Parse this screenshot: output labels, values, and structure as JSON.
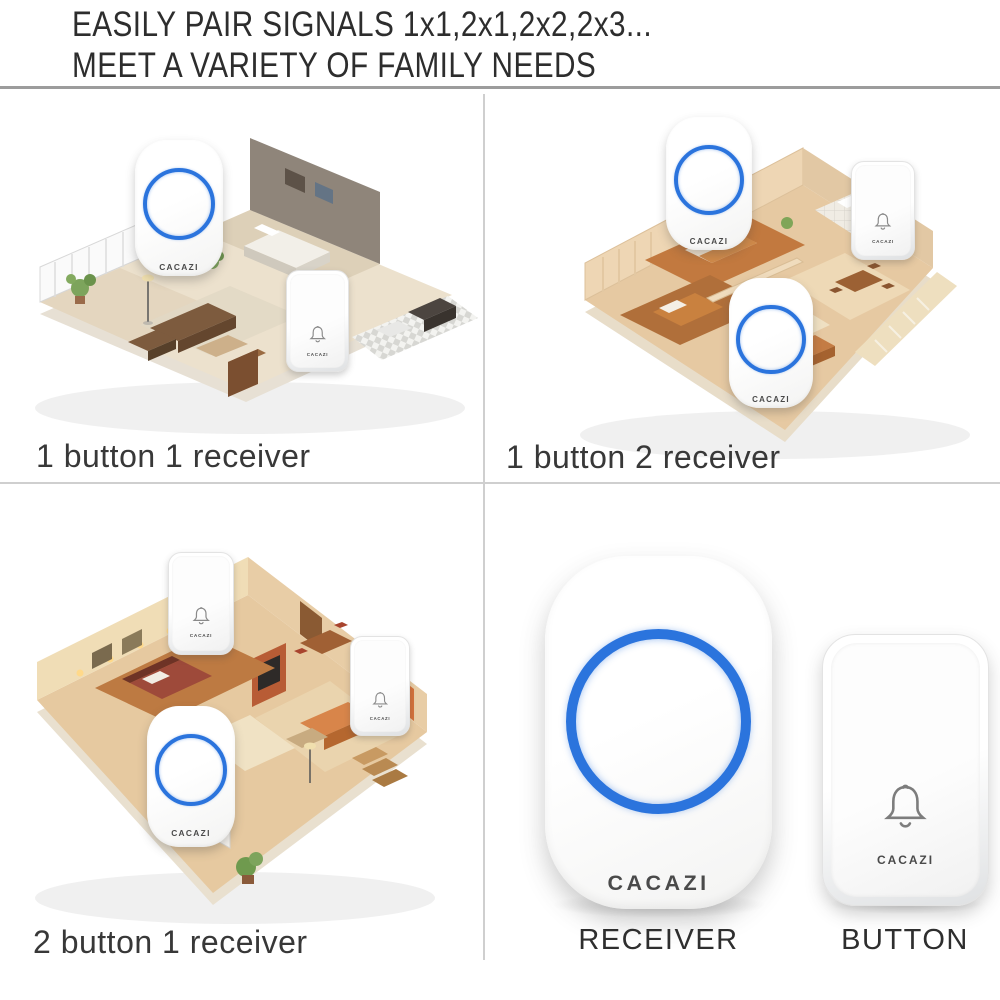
{
  "header": {
    "line1": "EASILY PAIR SIGNALS 1x1,2x1,2x2,2x3...",
    "line2": "MEET A VARIETY OF FAMILY NEEDS"
  },
  "brand": "CACAZI",
  "quadrants": [
    {
      "caption": "1 button 1 receiver",
      "buttons": 1,
      "receivers": 1
    },
    {
      "caption": "1 button 2 receiver",
      "buttons": 1,
      "receivers": 2
    },
    {
      "caption": "2 button 1 receiver",
      "buttons": 2,
      "receivers": 1
    }
  ],
  "products": {
    "receiver_label": "RECEIVER",
    "button_label": "BUTTON"
  },
  "icons": [
    {
      "name": "bell-icon",
      "shape": "outline bell glyph on push button"
    },
    {
      "name": "led-ring",
      "shape": "blue circular LED ring on receiver"
    }
  ],
  "colors": {
    "accent_blue": "#2b74dd",
    "divider": "#cfcfcf",
    "header_rule": "#9c9c9c",
    "text": "#383838",
    "background": "#ffffff"
  }
}
